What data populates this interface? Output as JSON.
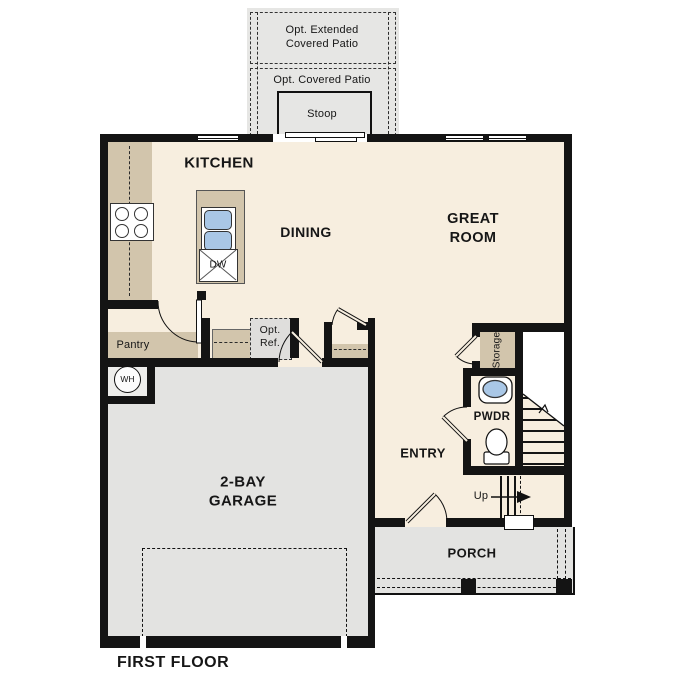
{
  "floor_title": "FIRST FLOOR",
  "rooms": {
    "kitchen": "KITCHEN",
    "dining": "DINING",
    "great_room": [
      "GREAT",
      "ROOM"
    ],
    "garage": [
      "2-BAY",
      "GARAGE"
    ],
    "entry": "ENTRY",
    "pwdr": "PWDR",
    "porch": "PORCH",
    "pantry": "Pantry",
    "storage": "Storage"
  },
  "outdoor": {
    "extended_patio": [
      "Opt. Extended",
      "Covered Patio"
    ],
    "covered_patio": "Opt. Covered Patio",
    "stoop": "Stoop"
  },
  "fixtures": {
    "opt_ref": [
      "Opt.",
      "Ref."
    ],
    "dishwasher": "DW",
    "water_heater": "WH",
    "stairs_up": "Up"
  },
  "colors": {
    "floor_cream": "#f7eedf",
    "cabinet_tan": "#d2c5ac",
    "garage_gray": "#e3e3e1",
    "patio_gray": "#e6e6e4",
    "wall": "#141414",
    "sink_blue": "#a9c7e6",
    "opt_ref_gray": "#dfdedc"
  }
}
